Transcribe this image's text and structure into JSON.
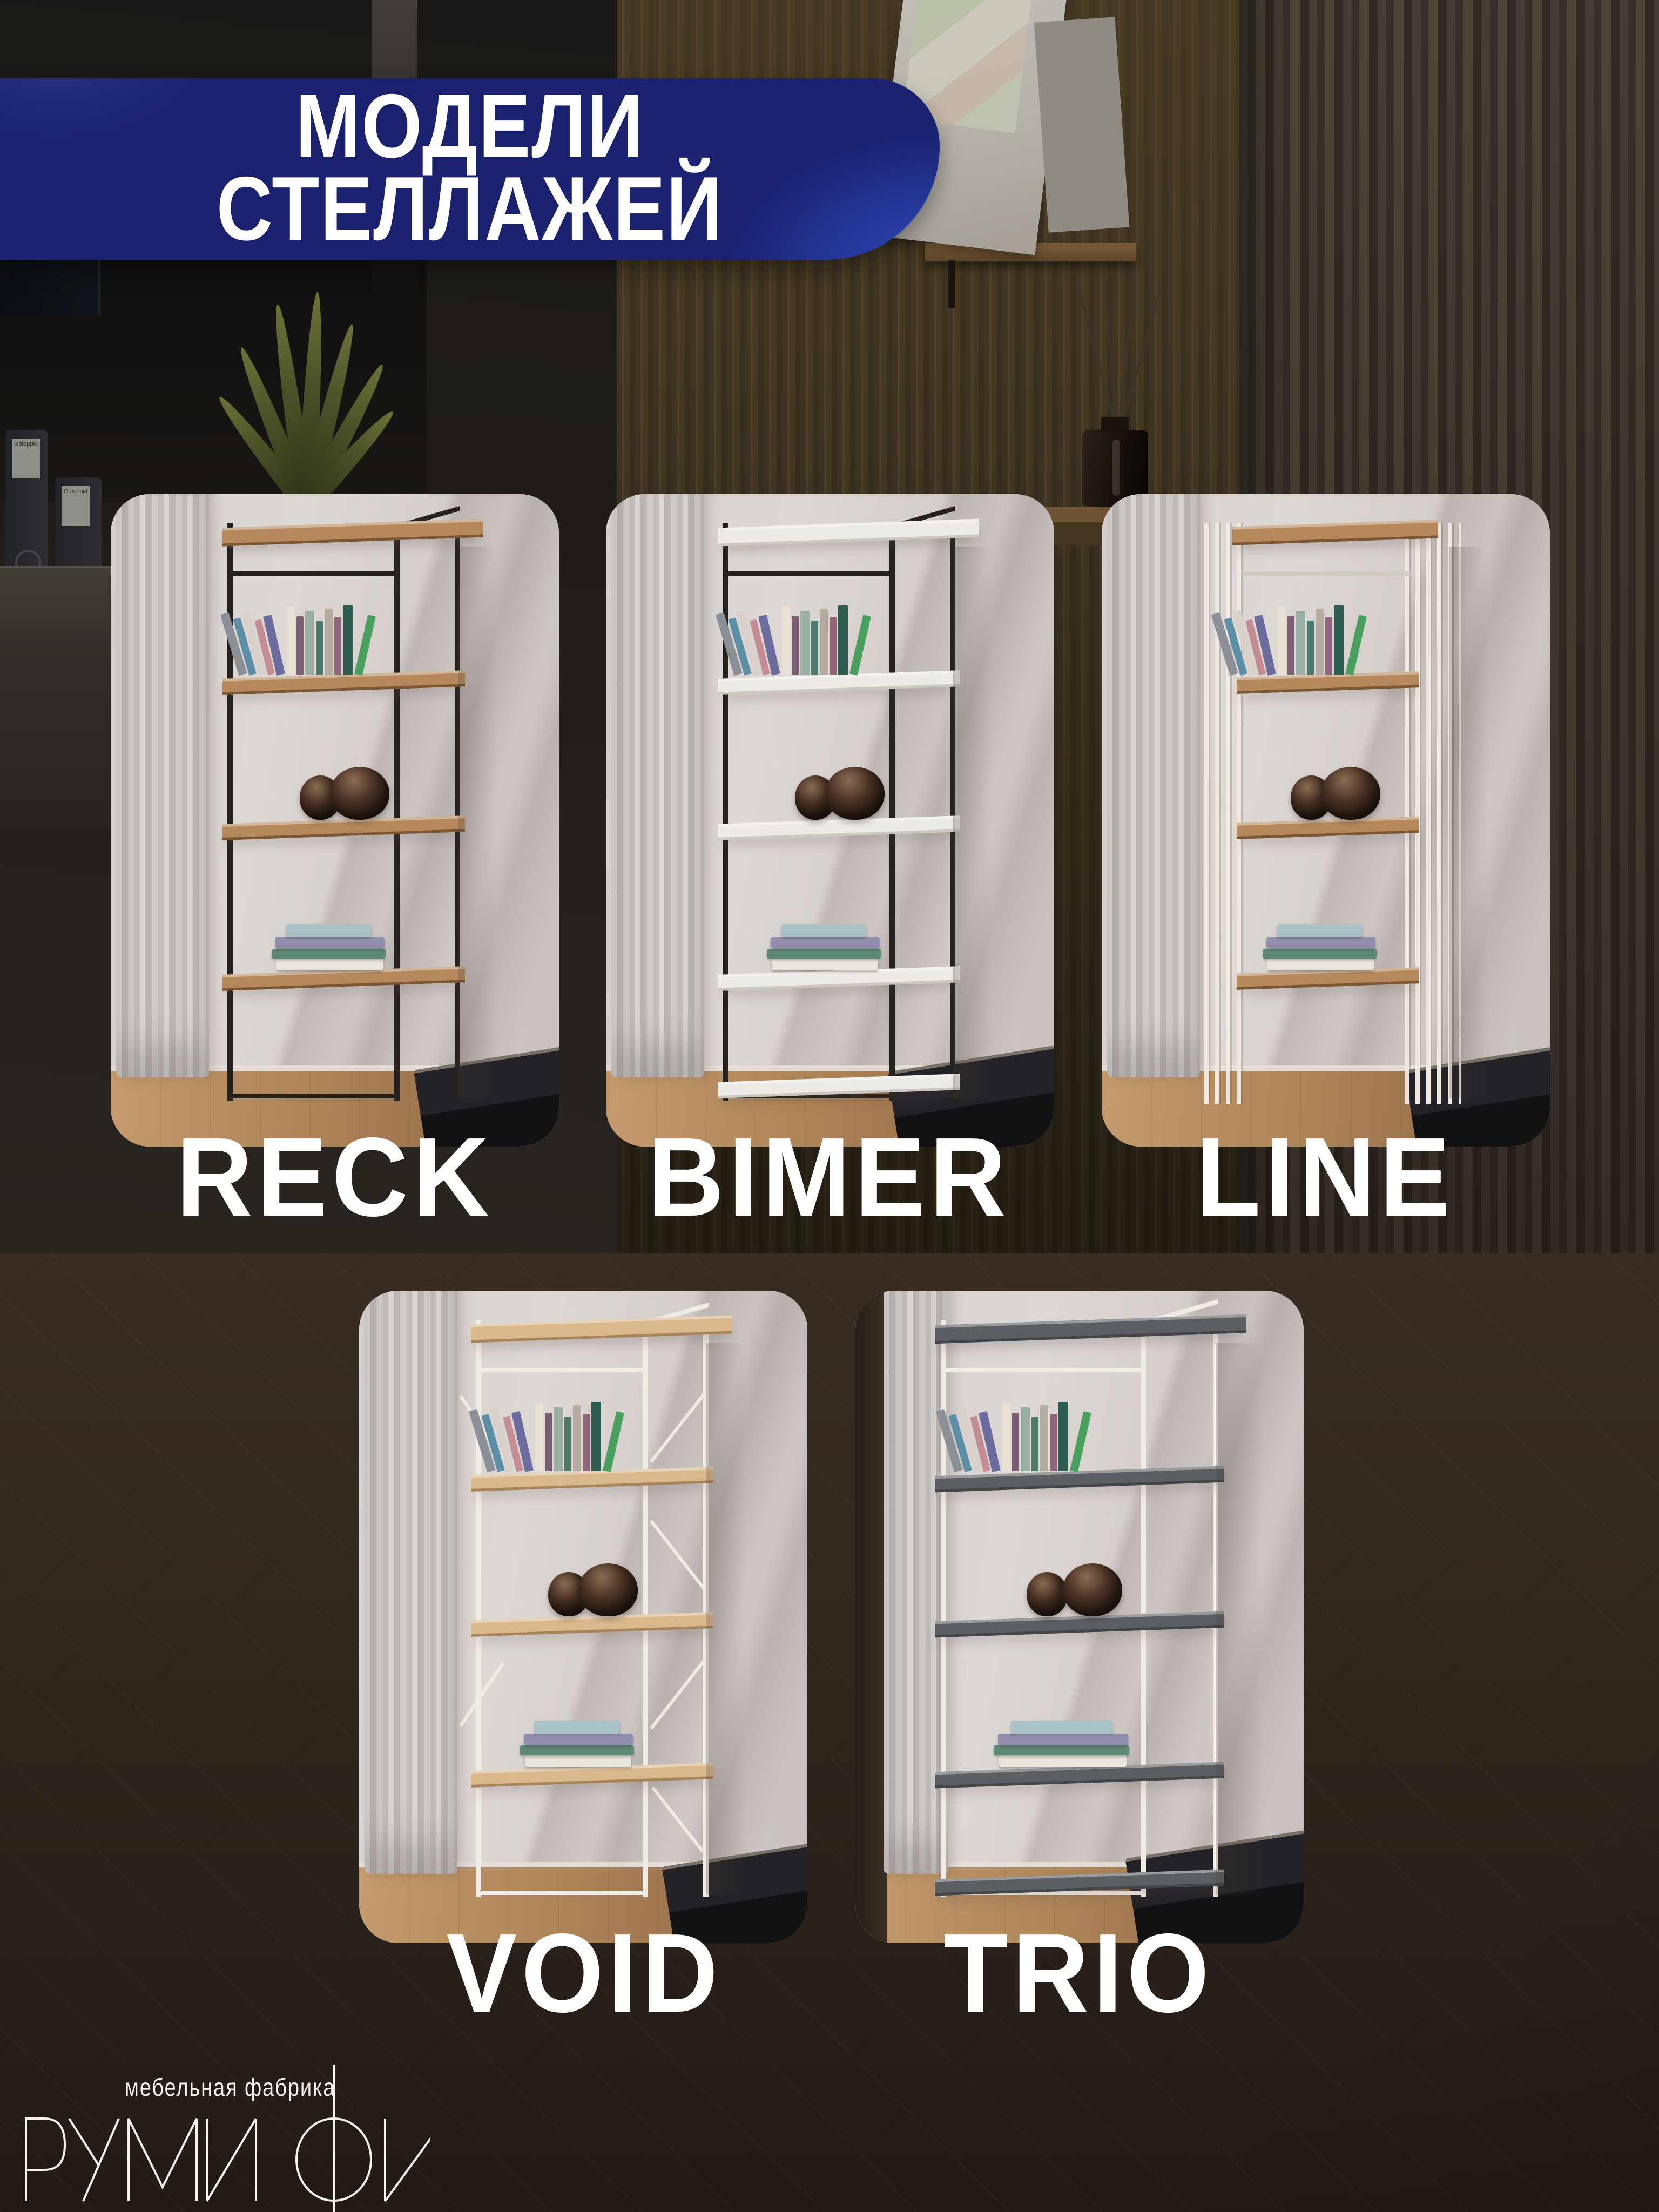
{
  "header": {
    "line1": "МОДЕЛИ",
    "line2": "СТЕЛЛАЖЕЙ",
    "background_color": "#1a2270",
    "accent_color": "#2e4cc0",
    "text_color": "#ffffff"
  },
  "products": [
    {
      "name": "RECK",
      "style": "frame",
      "frame_color": "#26221f",
      "board_color": "#b5895c",
      "board_edge": "#7d5734",
      "bottom_board": false
    },
    {
      "name": "BIMER",
      "style": "frame",
      "frame_color": "#26221f",
      "board_color": "#edebe6",
      "board_edge": "#ccc8c1",
      "bottom_board": true
    },
    {
      "name": "LINE",
      "style": "slats",
      "frame_color": "#eee8e0",
      "board_color": "#b5895c",
      "board_edge": "#7d5734",
      "bottom_board": false
    },
    {
      "name": "VOID",
      "style": "xbrace",
      "frame_color": "#f0ebe3",
      "board_color": "#d9b88c",
      "board_edge": "#a9835a",
      "bottom_board": false
    },
    {
      "name": "TRIO",
      "style": "frame",
      "frame_color": "#f0ebe3",
      "board_color": "#5b5e62",
      "board_edge": "#42454a",
      "bottom_board": true
    }
  ],
  "brand": {
    "tagline": "мебельная фабрика",
    "name": "РУМИФИ",
    "text_color": "#f6f3ef"
  },
  "background": {
    "binder_label": "Galoppid"
  },
  "decor": {
    "book_colors": [
      "#8b9096",
      "#5d8fa6",
      "#d9d0ca",
      "#c48d95",
      "#6c6d9e",
      "#e8e2d6",
      "#7c5f72",
      "#9db0a4",
      "#4d7a6a",
      "#b5aba0",
      "#8f667a",
      "#2e5d52",
      "#49a05e"
    ],
    "vase_color": "#3a2a1e",
    "stack_colors": [
      "#e8e5dd",
      "#5d8a78",
      "#938fae",
      "#aac3c9"
    ]
  }
}
